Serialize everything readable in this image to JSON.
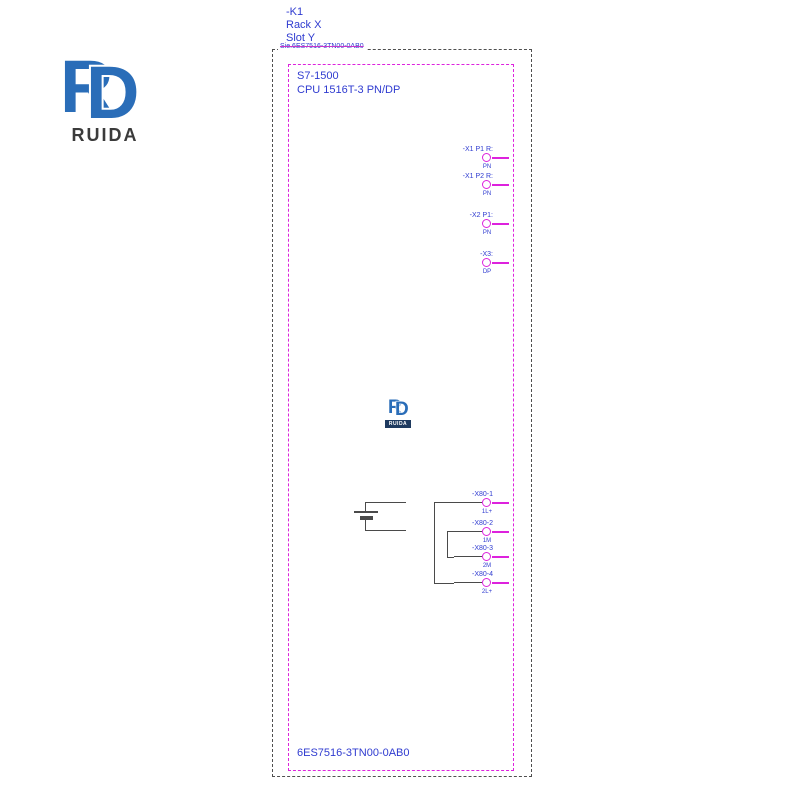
{
  "colors": {
    "schematic_blue": "#2f3bd0",
    "schematic_magenta": "#dd22dd",
    "wire_black": "#4a4a4a",
    "boundary_gray": "#4f4f4f",
    "logo_blue": "#2a6db8",
    "logo_text_gray": "#3b3b3b",
    "logo_bar_navy": "#1e3a5f"
  },
  "logo": {
    "monogram_left": "R",
    "monogram_right": "D",
    "brand": "RUIDA"
  },
  "watermark": {
    "monogram_left": "R",
    "monogram_right": "D",
    "brand": "RUIDA"
  },
  "header": {
    "device_tag": "-K1",
    "rack": "Rack X",
    "slot": "Slot Y",
    "struck_part_number": "Sie.6ES7516-3TN00-0AB0"
  },
  "module": {
    "series": "S7-1500",
    "name": "CPU 1516T-3 PN/DP",
    "order_number": "6ES7516-3TN00-0AB0"
  },
  "ports_top": [
    {
      "label": "-X1 P1 R:",
      "function": "PN"
    },
    {
      "label": "-X1 P2 R:",
      "function": "PN"
    },
    {
      "label": "-X2 P1:",
      "function": "PN"
    },
    {
      "label": "-X3:",
      "function": "DP"
    }
  ],
  "power_pins": [
    {
      "label": "-X80-1",
      "function": "1L+"
    },
    {
      "label": "-X80-2",
      "function": "1M"
    },
    {
      "label": "-X80-3",
      "function": "2M"
    },
    {
      "label": "-X80-4",
      "function": "2L+"
    }
  ]
}
